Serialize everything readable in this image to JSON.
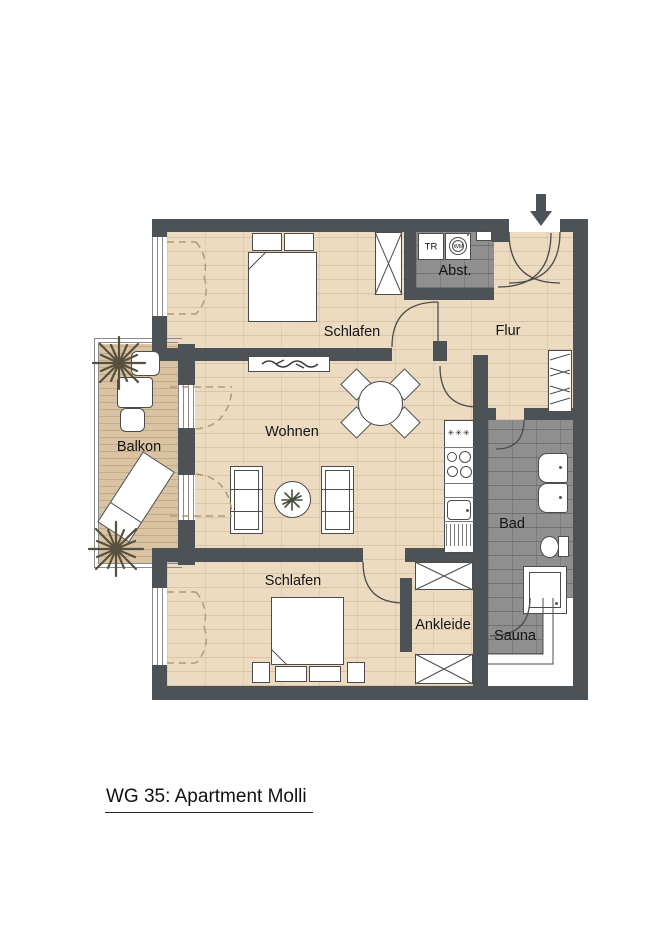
{
  "title": {
    "text": "WG 35: Apartment Molli"
  },
  "rooms": {
    "schlafen_top": {
      "label": "Schlafen"
    },
    "abstellraum": {
      "label": "Abst."
    },
    "flur": {
      "label": "Flur"
    },
    "wohnen": {
      "label": "Wohnen"
    },
    "balkon": {
      "label": "Balkon"
    },
    "bad": {
      "label": "Bad"
    },
    "schlafen_bottom": {
      "label": "Schlafen"
    },
    "ankleide": {
      "label": "Ankleide"
    },
    "sauna": {
      "label": "Sauna"
    }
  },
  "appliances": {
    "dryer_label": "TR",
    "washer_label": "WM",
    "hob_symbols": "✳✳✳"
  },
  "colors": {
    "wall": "#4d5257",
    "wood_floor": "#ecdbc1",
    "balcony_deck": "#d9c3a2",
    "tile": "#8f8f8f",
    "fixture_outline": "#4c4c4c"
  }
}
